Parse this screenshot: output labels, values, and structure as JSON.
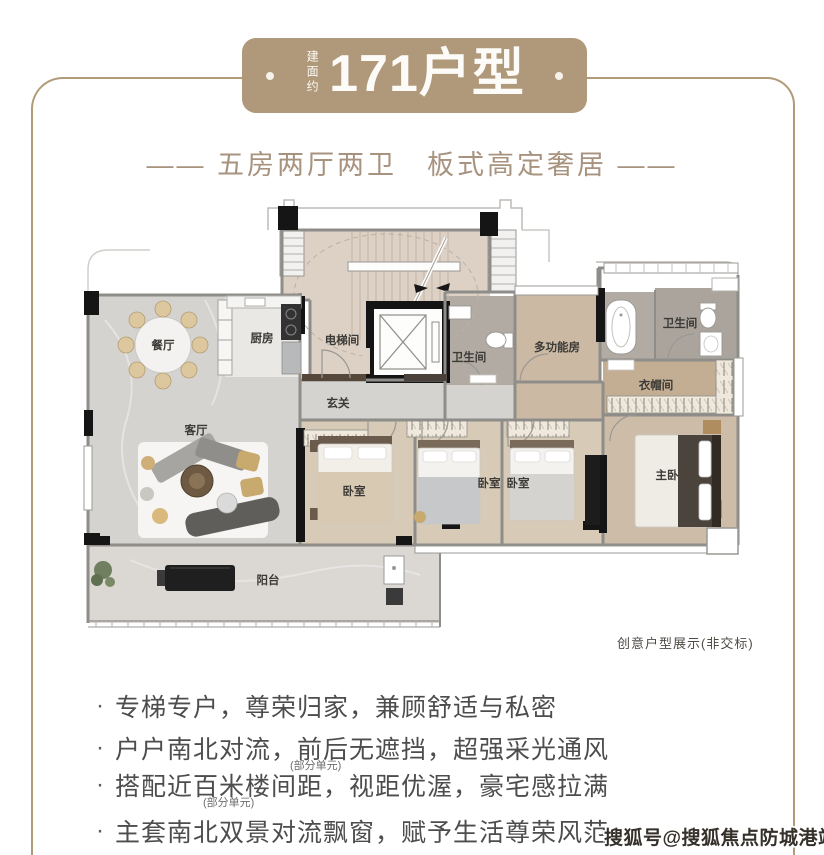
{
  "badge": {
    "area_label": "建面约",
    "title": "171户型"
  },
  "subtitle": "—— 五房两厅两卫　板式高定奢居 ——",
  "plan": {
    "rooms": {
      "dining": "餐厅",
      "kitchen": "厨房",
      "elevator": "电梯间",
      "foyer": "玄关",
      "bath1": "卫生间",
      "multi": "多功能房",
      "bath2": "卫生间",
      "closet": "衣帽间",
      "living": "客厅",
      "bedroom1": "卧室",
      "bedroom2": "卧室",
      "bedroom3": "卧室",
      "master": "主卧",
      "balcony": "阳台"
    },
    "note": "创意户型展示(非交标)"
  },
  "features": {
    "bullet": "·",
    "items": [
      {
        "text": "专梯专户，尊荣归家，兼顾舒适与私密"
      },
      {
        "text": "户户南北对流，前后无遮挡，超强采光通风",
        "sub": "(部分单元)"
      },
      {
        "text": "搭配近百米楼间距，视距优渥，豪宅感拉满",
        "sub": "(部分单元)"
      },
      {
        "text": "主套南北双景对流飘窗，赋予生活尊荣风范"
      }
    ]
  },
  "watermark": "搜狐号@搜狐焦点防城港站",
  "colors": {
    "accent": "#b0997a",
    "frame": "#b29b79",
    "subtitle": "#a8937f",
    "body_text": "#4d4d4d"
  }
}
